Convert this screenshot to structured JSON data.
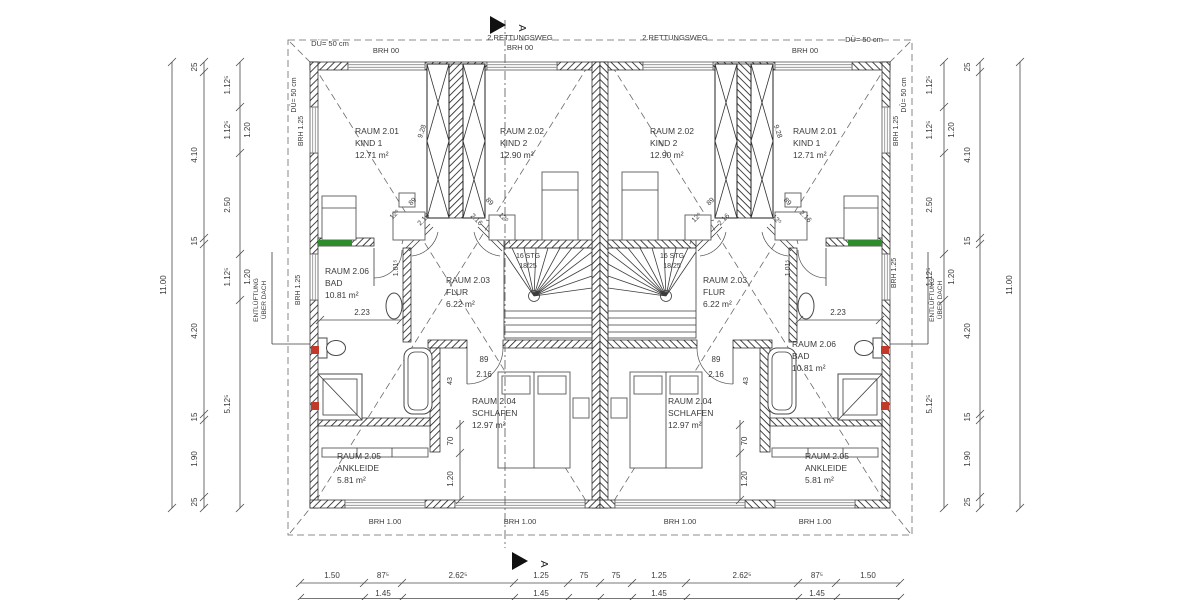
{
  "rooms": {
    "r201": {
      "name": "RAUM 2.01",
      "use": "KIND 1",
      "area": "12.71 m²"
    },
    "r202": {
      "name": "RAUM 2.02",
      "use": "KIND 2",
      "area": "12.90 m²"
    },
    "r203": {
      "name": "RAUM 2.03",
      "use": "FLUR",
      "area": "6.22 m²"
    },
    "r204": {
      "name": "RAUM 2.04",
      "use": "SCHLAFEN",
      "area": "12.97 m²"
    },
    "r205": {
      "name": "RAUM 2.05",
      "use": "ANKLEIDE",
      "area": "5.81 m²"
    },
    "r206": {
      "name": "RAUM 2.06",
      "use": "BAD",
      "area": "10.81 m²"
    }
  },
  "annotations": {
    "rescue": "2.RETTUNGSWEG",
    "brh00": "BRH 00",
    "brh125": "BRH 1.25",
    "brh100": "BRH 1.00",
    "du50": "DÜ= 50 cm",
    "vent1": "ENTLÜFTUNG",
    "vent2": "ÜBER DACH",
    "stairs1": "16 STG",
    "stairs2": "18/25",
    "section": "A"
  },
  "dims": {
    "bottom": [
      "1.50",
      "87⁵",
      "2.62⁵",
      "1.25",
      "75",
      "75",
      "1.25",
      "2.62⁵",
      "87⁵",
      "1.50"
    ],
    "bottom_sub": "1.45",
    "total_h": "11.00",
    "side": [
      "25",
      "4.10",
      "15",
      "4.20",
      "15",
      "1.90",
      "25"
    ],
    "side_inner": [
      "1.12⁵",
      "1.12⁵",
      "2.50",
      "1.12⁵",
      "5.12⁵"
    ],
    "win_h": "1.20",
    "bath_w": "2.23",
    "door_w": "89",
    "door_h": "2.16",
    "d125": "12⁵",
    "d43": "43",
    "d70": "70",
    "d120": "1.20",
    "d101": "1.01⁵",
    "d928": "9.28"
  },
  "colors": {
    "lintel": "#2e8b2e",
    "plumbing": "#c0392b"
  }
}
